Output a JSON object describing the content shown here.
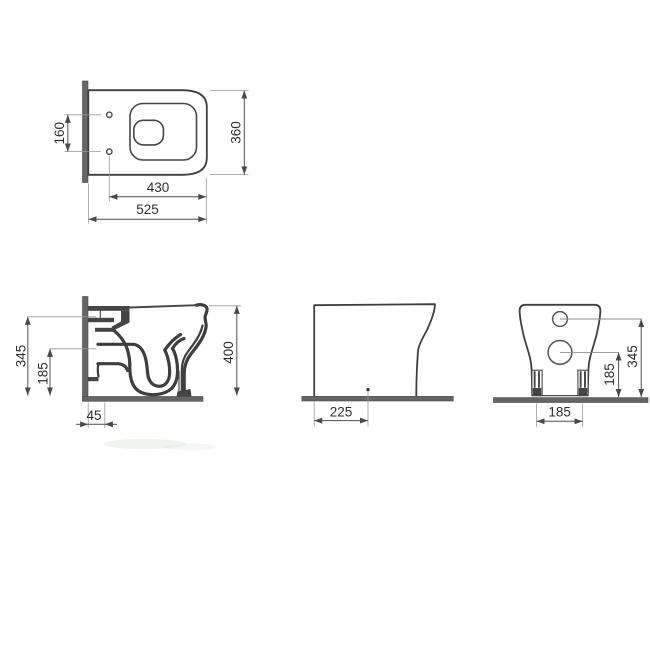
{
  "colors": {
    "line": "#3f3f3f",
    "dimension": "#4f4f4f",
    "wall_floor_fill": "#656565",
    "text": "#2e2e2e",
    "background": "#ffffff"
  },
  "plan_view": {
    "dim_hole_spacing": "160",
    "dim_overall_width": "360",
    "dim_bowl_depth": "430",
    "dim_overall_depth": "525"
  },
  "section_view": {
    "dim_inlet_height": "345",
    "dim_outlet_height": "185",
    "dim_outlet_offset": "45",
    "dim_overall_height": "400"
  },
  "side_view": {
    "dim_trap_distance": "225"
  },
  "rear_view": {
    "dim_inlet_height": "345",
    "dim_outlet_height": "185",
    "dim_fixing_spacing": "185"
  }
}
